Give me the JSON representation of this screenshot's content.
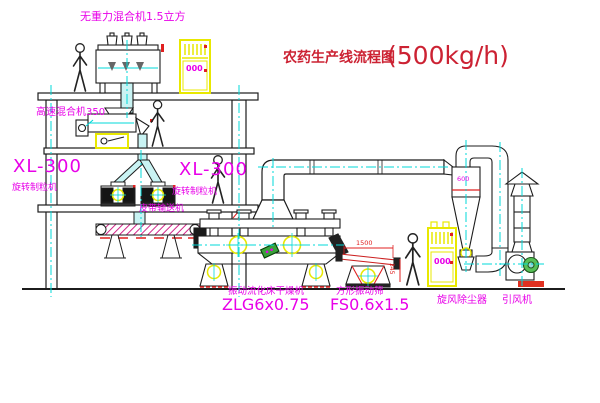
{
  "title": {
    "text": "农药生产线流程图",
    "capacity": "(500kg/h)"
  },
  "equipment_labels": {
    "gravity_mixer": "无重力混合机1.5立方",
    "high_speed_mixer": "高速混合机350",
    "granulator_left_model": "XL-300",
    "granulator_left_name": "旋转制粒机",
    "granulator_right_model": "XL-300",
    "granulator_right_name": "旋转制粒机",
    "belt_conveyor": "皮带输送机",
    "dryer_name": "振动流化床干燥机",
    "dryer_model": "ZLG6x0.75",
    "sieve_name": "方形振动筛",
    "sieve_model": "FS0.6x1.5",
    "cyclone_name": "旋风除尘器",
    "fan_name": "引风机"
  },
  "annotations": {
    "cyclone_size": "600",
    "cabinet_top_text": "000",
    "cabinet_right_text": "000",
    "sieve_width_dim": "1500",
    "sieve_height_dim": "345"
  },
  "colors": {
    "title_red": "#cc2233",
    "label_magenta": "#e800e8",
    "line_black": "#1c1c1c",
    "centerline_cyan": "#00d8d8",
    "cabinet_yellow": "#e8e800",
    "dimension_red": "#e02020",
    "pipe_fill_cyan": "#c9f3f3",
    "motor_green": "#3aa03a"
  }
}
